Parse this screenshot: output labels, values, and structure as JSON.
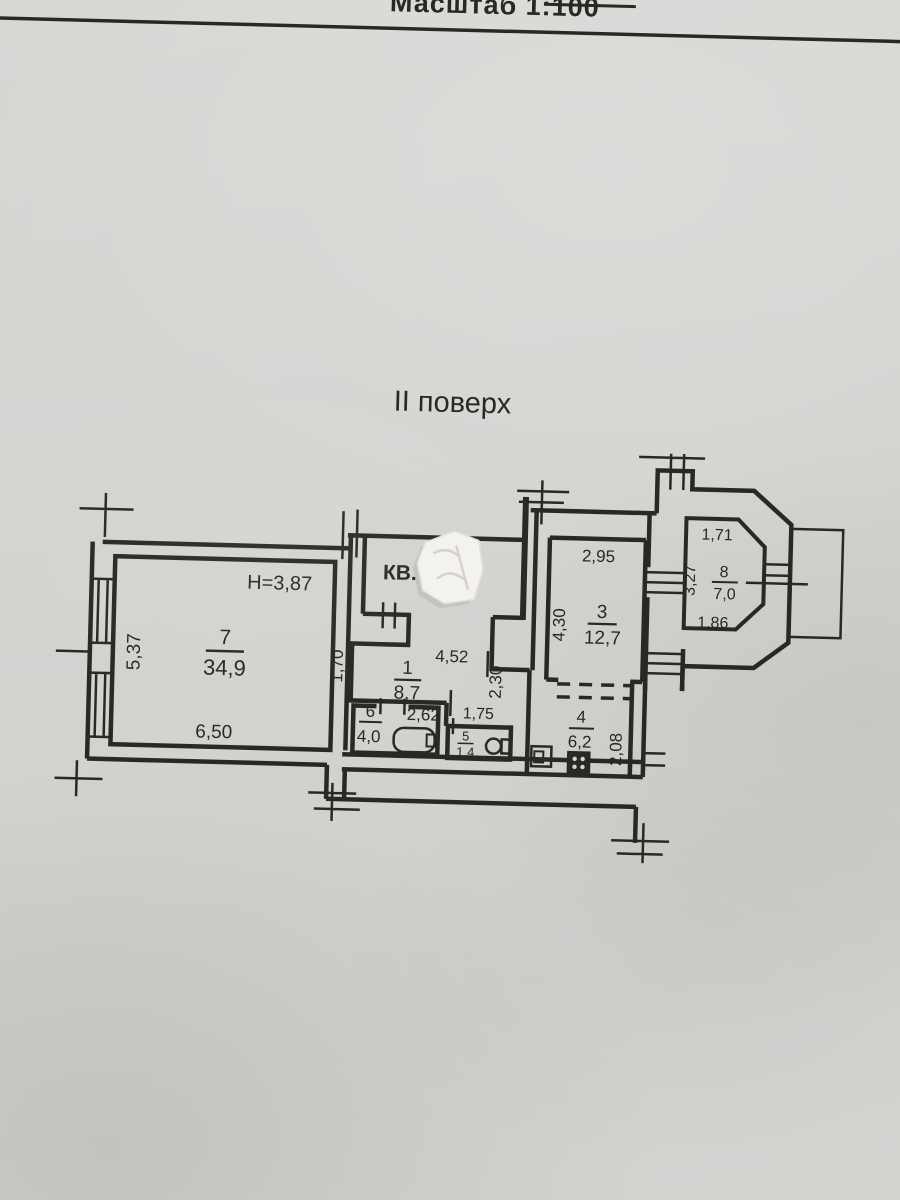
{
  "header": {
    "scale_label": "Масштаб 1:100",
    "floor_title": "II поверх"
  },
  "plan": {
    "apartment_label": "КВ.",
    "apartment_number_state": "covered-by-sticker",
    "ceiling_height": "H=3,87",
    "rooms": [
      {
        "number": "7",
        "area": "34,9",
        "dims": {
          "width": "6,50",
          "left": "5,37"
        }
      },
      {
        "number": "1",
        "area": "8,7",
        "dims": {
          "width": "4,52",
          "left": "1,70",
          "right": "2,30"
        }
      },
      {
        "number": "6",
        "area": "4,0",
        "dims": {
          "width": "2,62"
        }
      },
      {
        "number": "5",
        "area": "1,4",
        "dims": {
          "width": "1,75"
        }
      },
      {
        "number": "4",
        "area": "6,2",
        "dims": {
          "right": "2,08"
        }
      },
      {
        "number": "3",
        "area": "12,7",
        "dims": {
          "width": "2,95",
          "left": "4,30"
        }
      },
      {
        "number": "8",
        "area": "7,0",
        "dims": {
          "top": "1,71",
          "left": "3,27",
          "bottom": "1,86"
        }
      }
    ],
    "fixtures": [
      "bathtub",
      "toilet",
      "sink",
      "stove"
    ],
    "colors": {
      "ink": "#2a2824",
      "paper": "#d6d4d1",
      "sticker": "#f3f2ee"
    }
  }
}
